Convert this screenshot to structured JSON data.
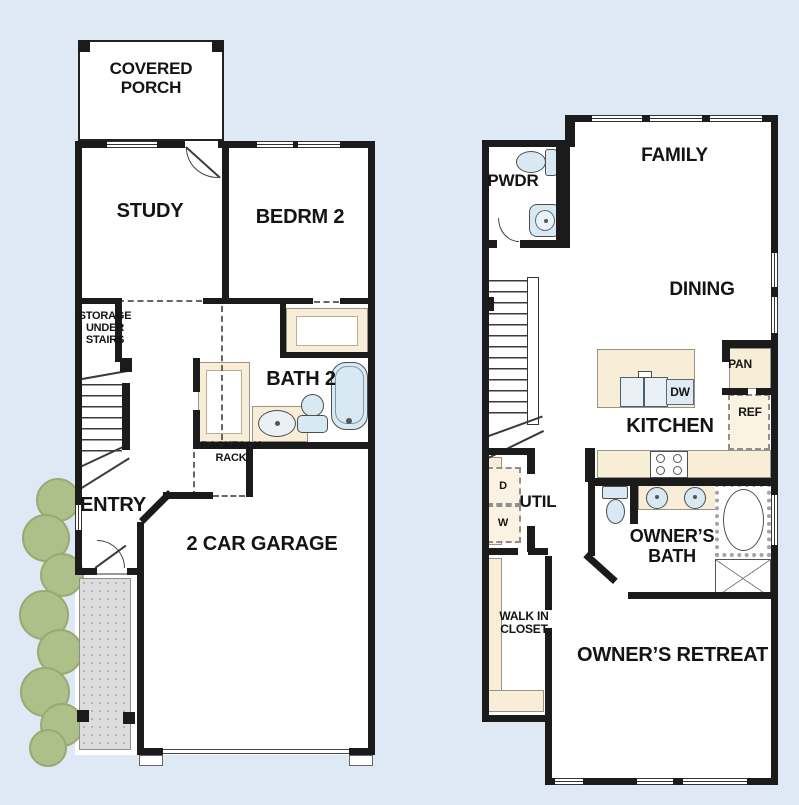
{
  "colors": {
    "background": "#dfe8f5",
    "wall": "#1b1b1b",
    "floor": "#ffffff",
    "casework": "#f8eed7",
    "fixture": "#d9e9f4",
    "landscape": "#aec089",
    "walkway": "#dcdcdc"
  },
  "floor1": {
    "labels": {
      "covered_porch": "COVERED PORCH",
      "study": "STUDY",
      "bedrm2": "BEDRM 2",
      "storage": "STORAGE UNDER STAIRS",
      "bath2": "BATH 2",
      "backpack_rack": "BACKPACK RACK",
      "entry": "ENTRY",
      "garage": "2 CAR GARAGE"
    }
  },
  "floor2": {
    "labels": {
      "pwdr": "PWDR",
      "family": "FAMILY",
      "dining": "DINING",
      "kitchen": "KITCHEN",
      "pantry": "PAN",
      "refrigerator": "REF",
      "dishwasher": "DW",
      "util": "UTIL",
      "dryer": "D",
      "washer": "W",
      "owners_bath": "OWNER’S BATH",
      "walk_in_closet": "WALK IN CLOSET",
      "owners_retreat": "OWNER’S RETREAT"
    }
  }
}
